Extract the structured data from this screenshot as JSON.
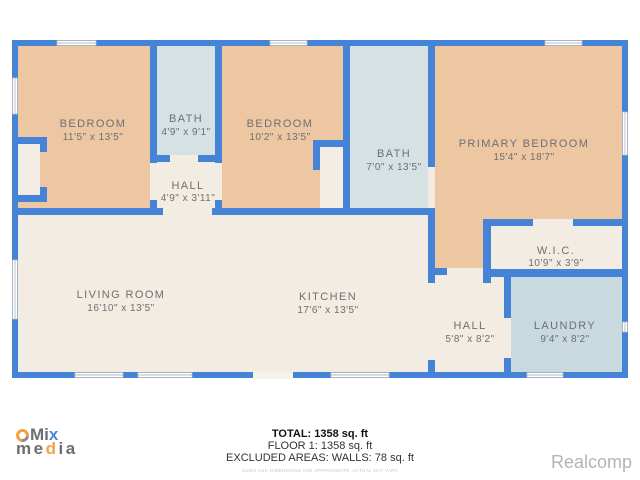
{
  "colors": {
    "wall_blue": "#4583d6",
    "room_tan": "#edc6a2",
    "room_bath_blue": "#d5e1e2",
    "room_laundry_blue": "#c8dadd",
    "floor_cream": "#f2ece3",
    "label_gray": "#6c6f75",
    "watermark_gray": "#b4b4b4",
    "logo_orange": "#f2a33c",
    "logo_gray": "#6d6e71",
    "logo_blue": "#4a86d8"
  },
  "rooms": [
    {
      "name": "BEDROOM",
      "dims": "11'5\" x 13'5\""
    },
    {
      "name": "BATH",
      "dims": "4'9\" x 9'1\""
    },
    {
      "name": "BEDROOM",
      "dims": "10'2\" x 13'5\""
    },
    {
      "name": "BATH",
      "dims": "7'0\" x 13'5\""
    },
    {
      "name": "PRIMARY BEDROOM",
      "dims": "15'4\" x 18'7\""
    },
    {
      "name": "HALL",
      "dims": "4'9\" x 3'11\""
    },
    {
      "name": "W.I.C.",
      "dims": "10'9\" x 3'9\""
    },
    {
      "name": "LIVING ROOM",
      "dims": "16'10\" x 13'5\""
    },
    {
      "name": "KITCHEN",
      "dims": "17'6\" x 13'5\""
    },
    {
      "name": "HALL",
      "dims": "5'8\" x 8'2\""
    },
    {
      "name": "LAUNDRY",
      "dims": "9'4\" x 8'2\""
    }
  ],
  "footer": {
    "total": "TOTAL: 1358 sq. ft",
    "floor1": "FLOOR 1: 1358 sq. ft",
    "excluded": "EXCLUDED AREAS: WALLS: 78 sq. ft",
    "disclaimer": "SIZES AND DIMENSIONS ARE APPROXIMATE, ACTUAL MAY VARY"
  },
  "logo": {
    "l1_m": "M",
    "l1_i": "i",
    "l1_x": "x",
    "l2_me": "me",
    "l2_d": "d",
    "l2_i": "i",
    "l2_a": "a"
  },
  "watermark": "Realcomp"
}
